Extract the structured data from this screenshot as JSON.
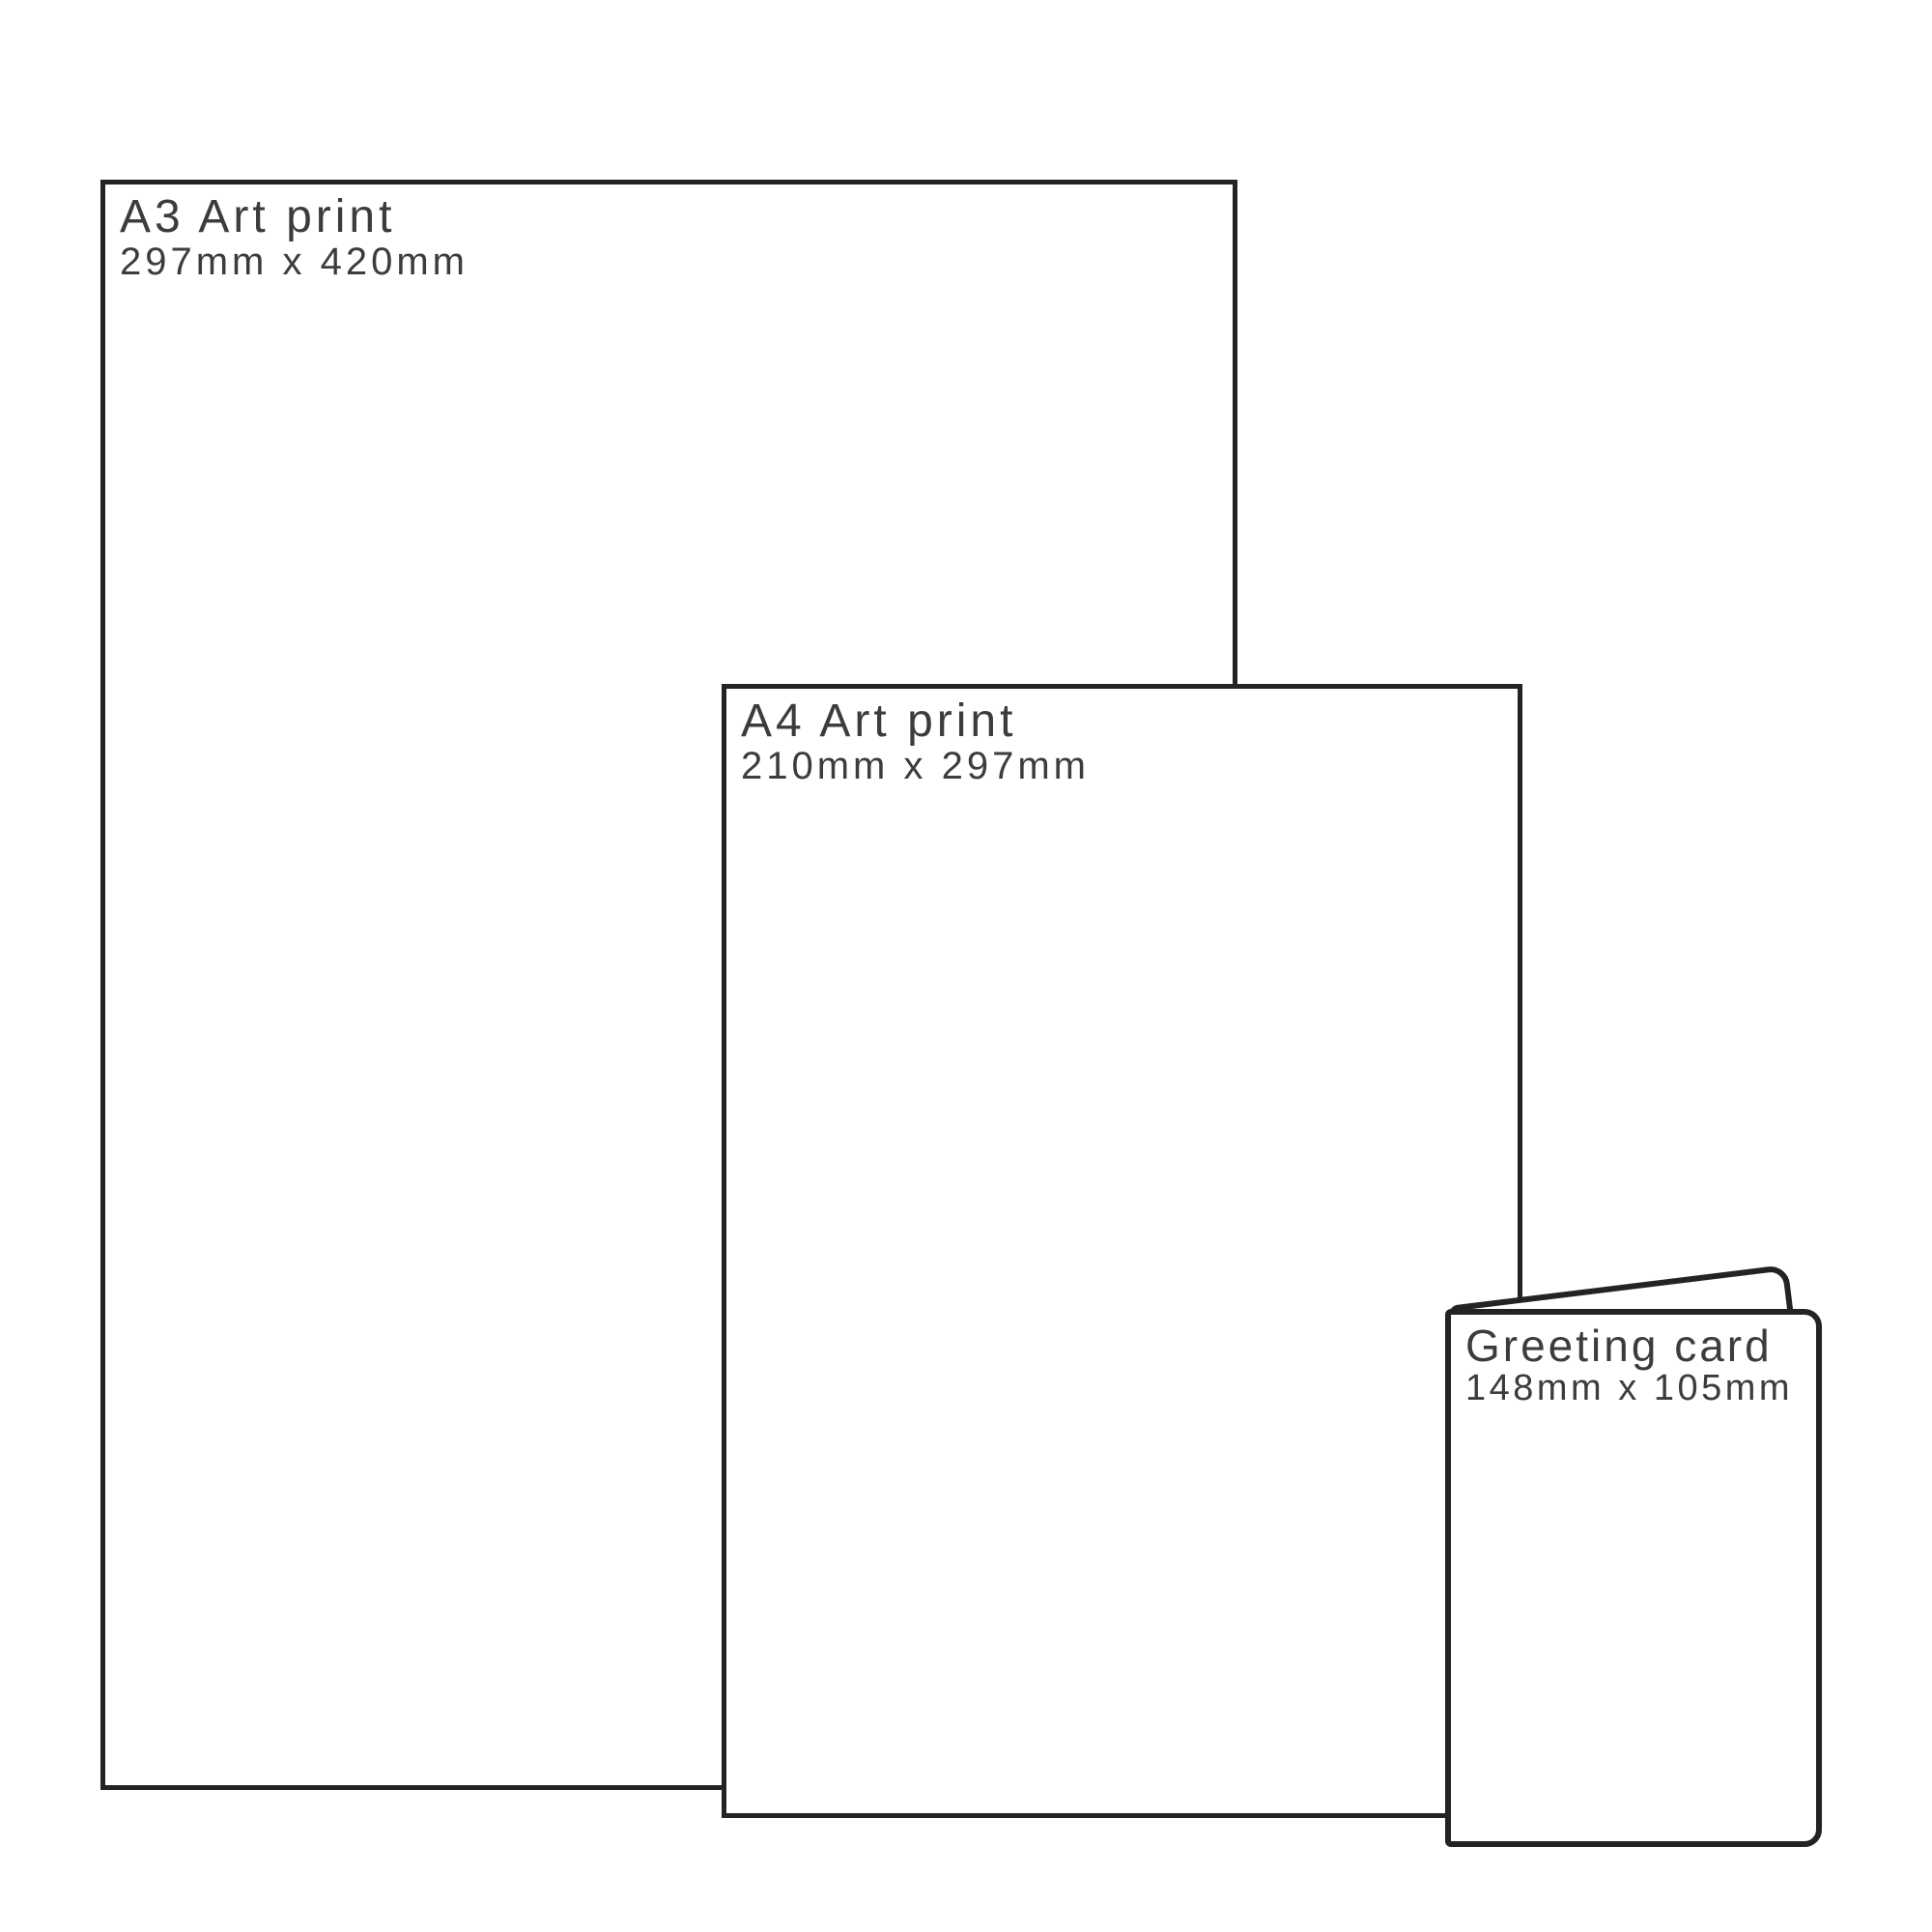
{
  "canvas": {
    "background": "#ffffff"
  },
  "style": {
    "outline_color": "#232323",
    "text_color": "#3c3c3c",
    "sheet_fill": "#ffffff"
  },
  "sheets": [
    {
      "id": "a3-art-print",
      "title": "A3 Art print",
      "dimensions": "297mm x 420mm"
    },
    {
      "id": "a4-art-print",
      "title": "A4 Art print",
      "dimensions": "210mm x 297mm"
    },
    {
      "id": "greeting-card",
      "title": "Greeting card",
      "dimensions": "148mm x 105mm"
    }
  ]
}
